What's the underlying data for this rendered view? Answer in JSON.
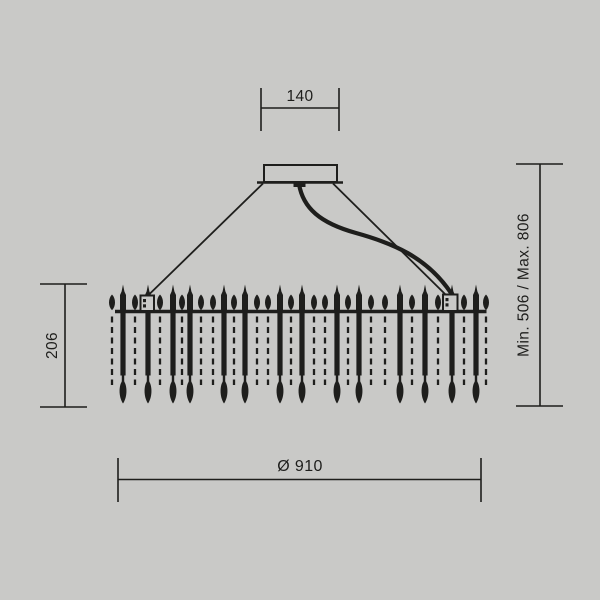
{
  "colors": {
    "background": "#c9c9c7",
    "ink": "#1e1e1c"
  },
  "dimensions": {
    "top": {
      "label": "140"
    },
    "left": {
      "label": "206"
    },
    "right": {
      "label": "Min. 506 / Max. 806"
    },
    "bottom": {
      "label": "Ø 910"
    }
  },
  "drawing": {
    "canopy": {
      "x": 264,
      "y": 165,
      "w": 73,
      "h": 17,
      "base_x1": 257,
      "base_y": 182.5,
      "base_x2": 343,
      "nub_x": 293.5,
      "nub_y": 181,
      "nub_w": 12,
      "nub_h": 6
    },
    "cables": {
      "left": {
        "x1": 263,
        "y1": 183.5,
        "x2": 147.5,
        "y2": 296
      },
      "right": {
        "x1": 333,
        "y1": 183.5,
        "x2": 445.5,
        "y2": 294.5
      },
      "cord_path": "M 299 184 C 303 208 320 223 356 233 C 392 243 427 257 451 293"
    },
    "chandelier": {
      "bar_x1": 115,
      "bar_x2": 486.5,
      "bar_y": 311.5,
      "rod_xs": [
        123,
        148,
        173,
        190,
        224,
        245,
        280,
        302,
        337,
        359,
        400,
        425,
        452,
        476
      ],
      "dash_xs": [
        112,
        135,
        160,
        182,
        201,
        213,
        234,
        257,
        268,
        291,
        314,
        325,
        348,
        371,
        385,
        412,
        438,
        464,
        486
      ],
      "rod_top_y": 284.5,
      "rod_tip_y": 403.5,
      "dash_bottom_y": 385,
      "connectors": [
        {
          "x": 140.5,
          "y": 295.5,
          "w": 13.5,
          "h": 15.5
        },
        {
          "x": 443,
          "y": 294.5,
          "w": 14.5,
          "h": 16.5
        }
      ]
    }
  }
}
